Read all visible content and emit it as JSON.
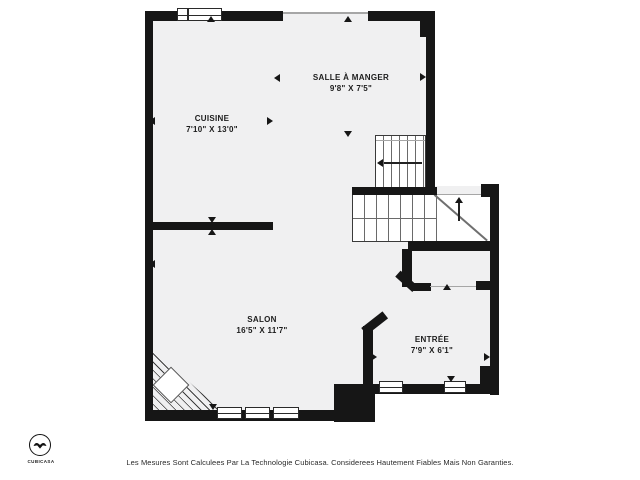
{
  "plan": {
    "rooms": [
      {
        "name": "CUISINE",
        "dims": "7'10\" X 13'0\""
      },
      {
        "name": "SALLE À MANGER",
        "dims": "9'8\" X 7'5\""
      },
      {
        "name": "SALON",
        "dims": "16'5\" X 11'7\""
      },
      {
        "name": "ENTRÉE",
        "dims": "7'9\" X 6'1\""
      }
    ],
    "disclaimer": "Les Mesures Sont Calculees Par La Technologie Cubicasa. Considerees Hautement Fiables Mais Non Garanties.",
    "logo": {
      "brand": "CUBICASA"
    },
    "colors": {
      "wall": "#161616",
      "floor": "#f0f0f1",
      "background": "#ffffff",
      "stair_tread": "#6a6a6a"
    }
  }
}
